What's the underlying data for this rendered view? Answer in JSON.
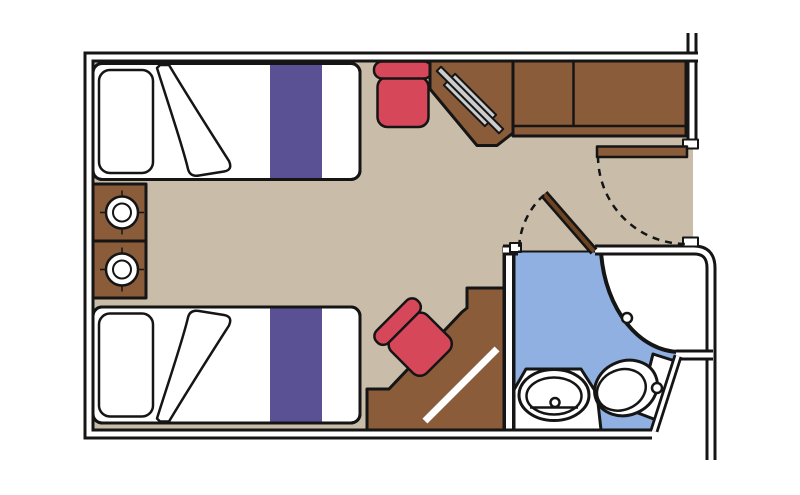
{
  "diagram": {
    "type": "floor-plan",
    "rooms": [
      "cabin",
      "bathroom"
    ],
    "items": [
      "twin-bed-top",
      "twin-bed-bottom",
      "bed-pillow",
      "bed-runner-stripe",
      "folded-duvet",
      "nightstand-upper",
      "nightstand-lower",
      "table-lamp",
      "stool-top",
      "stool-bottom",
      "corner-desk-with-mirror",
      "wardrobe-two-door",
      "vanity-desk",
      "entrance-door-open",
      "entrance-door-swing",
      "bathroom-door-open",
      "bathroom-door-swing",
      "shower-enclosure",
      "shower-drain",
      "washbasin-counter",
      "washbasin",
      "toilet-with-cistern",
      "corridor-wall"
    ]
  },
  "colors": {
    "background": "#ffffff",
    "wall-line": "#151515",
    "floor": "#c9bdaa",
    "wood": "#8a5c3a",
    "wood-dark": "#6f4423",
    "linen": "#ffffff",
    "bed-stripe": "#5a5094",
    "stool-red": "#d7475a",
    "bath-floor": "#8fb0e0",
    "fixture": "#ffffff",
    "mirror-gray": "#cccccc"
  }
}
